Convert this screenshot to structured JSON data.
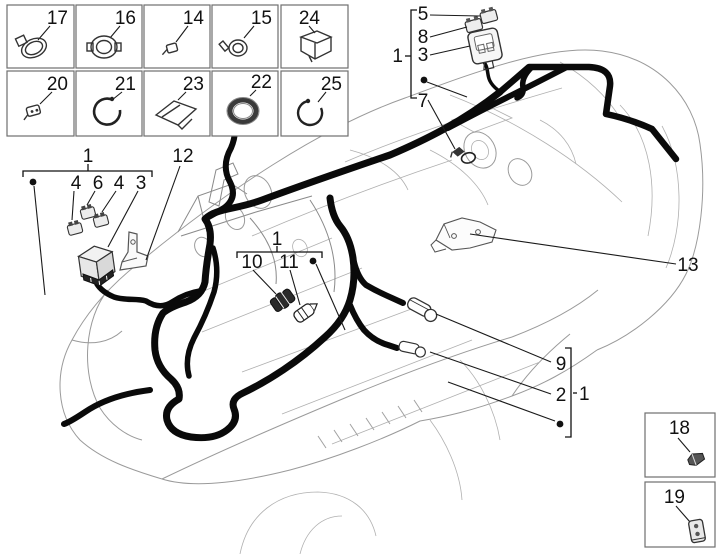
{
  "legend": {
    "row1": [
      {
        "num": "17",
        "icon": "hose-clamp-icon"
      },
      {
        "num": "16",
        "icon": "ring-clamp-icon"
      },
      {
        "num": "14",
        "icon": "small-clip-icon"
      },
      {
        "num": "15",
        "icon": "screw-clamp-icon"
      },
      {
        "num": "24",
        "icon": "bracket-holder-icon"
      }
    ],
    "row2": [
      {
        "num": "20",
        "icon": "cable-clip-icon"
      },
      {
        "num": "21",
        "icon": "band-clamp-icon"
      },
      {
        "num": "23",
        "icon": "protection-pad-icon"
      },
      {
        "num": "22",
        "icon": "gasket-ring-icon"
      },
      {
        "num": "25",
        "icon": "circlip-icon"
      }
    ],
    "side": [
      {
        "num": "18",
        "icon": "clip-icon"
      },
      {
        "num": "19",
        "icon": "connector-icon"
      }
    ]
  },
  "callouts": {
    "top_right": {
      "group": "1",
      "f5": "5",
      "f8": "8",
      "f3": "3",
      "f7": "7"
    },
    "left": {
      "group": "1",
      "f4a": "4",
      "f6": "6",
      "f4b": "4",
      "f3": "3",
      "f12": "12"
    },
    "center": {
      "group": "1",
      "f10": "10",
      "f11": "11"
    },
    "right": {
      "group": "1",
      "f9": "9",
      "f2": "2"
    },
    "f13": "13"
  },
  "colors": {
    "harness": "#0a0a0a",
    "body_outline": "#9a9a9a",
    "box_border": "#6f6f6f"
  }
}
